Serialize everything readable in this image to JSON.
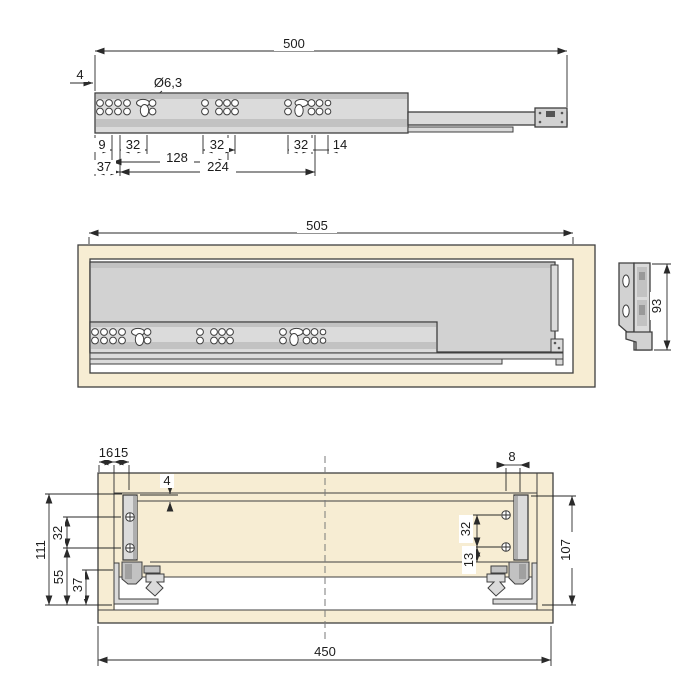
{
  "drawing_type": "drawer-slide-technical-drawing",
  "colors": {
    "wood": "#f7edd3",
    "panel_gray": "#d2d2d2",
    "rail_gray": "#dbdbdb",
    "band_gray": "#c2c2c2",
    "outline": "#3f3f3f",
    "dimension": "#2a2a2a",
    "background": "#ffffff"
  },
  "top_view": {
    "length_total": "500",
    "edge_offset": "4",
    "hole_diameter": "Ø6,3",
    "pitch_9": "9",
    "pitch_32_a": "32",
    "span_128": "128",
    "pitch_32_b": "32",
    "pitch_32_c": "32",
    "end_14": "14",
    "front_37": "37",
    "span_224": "224"
  },
  "middle_view": {
    "length_total": "505",
    "profile_height": "93"
  },
  "bottom_view": {
    "front_16": "16",
    "gap_15": "15",
    "top_gap_4": "4",
    "height_111": "111",
    "screw_pitch_left_32": "32",
    "bottom_55": "55",
    "rail_37": "37",
    "back_8": "8",
    "screw_pitch_right_32": "32",
    "screw_13": "13",
    "height_107": "107",
    "width_450": "450"
  }
}
